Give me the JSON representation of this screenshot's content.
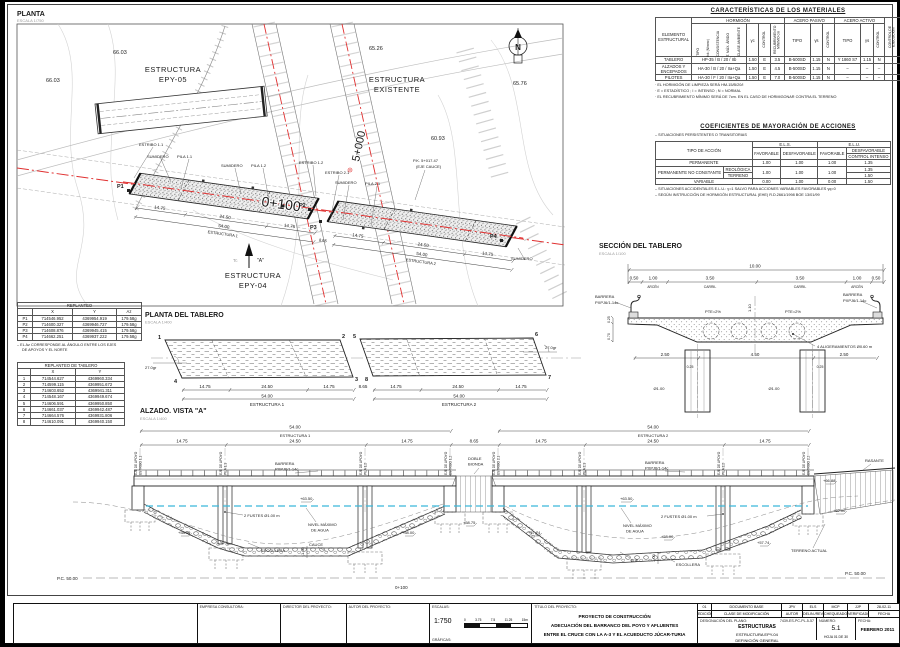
{
  "plan": {
    "title": "PLANTA",
    "scale": "ESCALA 1/750",
    "structures": {
      "epy05a": "ESTRUCTURA",
      "epy05b": "EPY-05",
      "exa": "ESTRUCTURA",
      "exb": "EXISTENTE",
      "epy04a": "ESTRUCTURA",
      "epy04b": "EPY-04"
    },
    "contours": {
      "c1": "66.03",
      "c2": "66.03",
      "c3": "65.26",
      "c4": "60.93",
      "c5": "65.76"
    },
    "stations": {
      "s1": "5+000",
      "s2": "0+100"
    },
    "points": {
      "p1": "P1",
      "p2": "P2",
      "p3": "P3",
      "p4": "P4"
    },
    "callouts": {
      "estribo11": "ESTRIBO 1.1",
      "sumidero": "SUMIDERO",
      "pila11": "PILA 1.1",
      "pila12": "PILA 1.2",
      "estribo12": "ESTRIBO 1.2",
      "estribo21": "ESTRIBO 2.1",
      "pila21": "PILA 2.1",
      "pk": "P.K. 5+017.47",
      "pk2": "(EJE CAUCE)"
    },
    "dims": {
      "d1475": "14.75",
      "d2450": "24.50",
      "d5400": "54.00",
      "e1": "ESTRUCTURA 1",
      "e2": "ESTRUCTURA 2",
      "d865": "8.65"
    },
    "view_arrow": "\"A\"",
    "view_tc": "Tc",
    "north": "N"
  },
  "materials": {
    "title": "CARACTERÍSTICAS DE LOS MATERIALES",
    "h_elem": "ELEMENTO ESTRUCTURAL",
    "h_horm": "HORMIGÓN",
    "h_pasivo": "ACERO PASIVO",
    "h_activo": "ACERO ACTIVO",
    "h_tipo": "TIPO",
    "h_fck": "fck (N/mm²)",
    "h_cons": "CONSISTENCIA",
    "h_arido": "T. MÁX. ÁRIDO",
    "h_amb": "CLASE AMBIENTE",
    "h_gc": "γc",
    "h_control": "CONTROL",
    "h_recub": "RECUBRIMIENTO MÍNIMO cm",
    "h_gs": "γs",
    "h_ejec": "CONTROL DE EJECUCIÓN",
    "rows": [
      [
        "TABLERO",
        "HP-35 / B / 20 / IIb",
        "1.50",
        "E",
        "3.5",
        "B-500SD",
        "1.15",
        "N",
        "Y 1860 S7",
        "1.15",
        "N",
        "I"
      ],
      [
        "ALZADOS Y ENCEPADOS",
        "HA-30 / B / 20 / IIa+Qa",
        "1.50",
        "E",
        "4.5",
        "B-500SD",
        "1.15",
        "N",
        "–",
        "–",
        "–",
        "I"
      ],
      [
        "PILOTES",
        "HA-30 / F / 20 / IIa+Qa",
        "1.50",
        "E",
        "7.0",
        "B-500SD",
        "1.15",
        "N",
        "–",
        "–",
        "–",
        "I"
      ]
    ],
    "notes": [
      "· EL HORMIGÓN DE LIMPIEZA SERÁ HM-15/B/20/I",
      "· E = ESTADÍSTICO ; I = INTENSO ; N = NORMAL",
      "· EL RECUBRIMIENTO MÍNIMO SERÁ DE 7cm. EN EL CASO DE HORMIGONAR CONTRA EL TERRENO"
    ]
  },
  "coefs": {
    "title": "COEFICIENTES DE MAYORACIÓN DE ACCIONES",
    "subtitle": "– SITUACIONES PERSISTENTES O TRANSITORIAS",
    "h_tipo": "TIPO DE ACCIÓN",
    "h_els": "E.L.S.",
    "h_elu": "E.L.U.",
    "h_fav": "FAVORABLE",
    "h_desf": "DESFAVORABLE",
    "h_ci": "CONTROL INTENSO",
    "r1": "PERMANENTE",
    "r1v": [
      "1.00",
      "1.00",
      "1.00",
      "1.35"
    ],
    "r2": "PERMANENTE NO CONSTANTE",
    "r2a": "REOLÓGICA",
    "r2b": "TERRENO",
    "r2v": [
      "1.00",
      "1.00",
      "1.00"
    ],
    "r2va": "1.35",
    "r2vb": "1.50",
    "r3": "VARIABLE",
    "r3v": [
      "0.00",
      "1.00",
      "0.00",
      "1.50"
    ],
    "notes": [
      "– SITUACIONES ACCIDENTALES E.L.U.: γ=1 SALVO PARA ACCIONES VARIABLES FAVORABLES γq=0",
      "– SEGÚN INSTRUCCIÓN DE HORMIGÓN ESTRUCTURAL (EHE) R.D.2661/1998 BOE 13/01/99"
    ]
  },
  "replanteo": {
    "title": "REPLANTEO",
    "headers": [
      "",
      "X",
      "Y",
      "Az"
    ],
    "rows": [
      [
        "P1",
        "714546.952",
        "4369954.919",
        "179.58g"
      ],
      [
        "P2",
        "714600.327",
        "4369946.727",
        "179.58g"
      ],
      [
        "P3",
        "714608.876",
        "4369945.415",
        "179.58g"
      ],
      [
        "P4",
        "714662.251",
        "4369937.222",
        "179.58g"
      ]
    ],
    "note1": "– EL Az CORRESPONDE AL ÁNGULO ENTRE LOS EJES",
    "note2": "DE APOYOS Y EL NORTE"
  },
  "replanteo_tablero": {
    "title": "REPLANTEO DE TABLERO",
    "headers": [
      "",
      "X",
      "Y"
    ],
    "rows": [
      [
        "1",
        "714544.627",
        "4369960.334"
      ],
      [
        "2",
        "714599.115",
        "4369951.672"
      ],
      [
        "3",
        "714603.652",
        "4369941.311"
      ],
      [
        "4",
        "714548.167",
        "4369949.674"
      ],
      [
        "5",
        "714606.591",
        "4369950.850"
      ],
      [
        "6",
        "714661.037",
        "4369942.487"
      ],
      [
        "7",
        "714664.576",
        "4369931.806"
      ],
      [
        "8",
        "714610.091",
        "4369940.150"
      ]
    ]
  },
  "section": {
    "title": "SECCIÓN DEL TABLERO",
    "scale": "ESCALA 1/100",
    "dims": {
      "total": "10.00",
      "d050": "0.50",
      "d100": "1.00",
      "d350": "3.50",
      "arcen": "ARCÉN",
      "carril": "CARRIL",
      "d250": "2.50",
      "d450": "4.50",
      "d025": "0.25",
      "d070": "0.70",
      "d110": "1.10",
      "dia": "Ø1.00"
    },
    "labels": {
      "pte": "PTE=2%",
      "bar1": "BARRERA",
      "bar2": "PXPJ6/1-14c",
      "alig": "4 ALIGERAMIENTOS Ø0.60 m"
    }
  },
  "deck_plan": {
    "title": "PLANTA DEL TABLERO",
    "scale": "ESCALA 1/400",
    "corners": [
      "1",
      "2",
      "3",
      "4",
      "5",
      "6",
      "7",
      "8"
    ],
    "angle": "27.0gr",
    "dims": {
      "d1475": "14.75",
      "d2450": "24.50",
      "d5400": "54.00",
      "e1": "ESTRUCTURA 1",
      "e2": "ESTRUCTURA 2",
      "gap": "8.65"
    }
  },
  "elevation": {
    "title": "ALZADO. VISTA \"A\"",
    "scale": "ESCALA 1/400",
    "dims": {
      "d5400": "54.00",
      "e1": "ESTRUCTURA 1",
      "e2": "ESTRUCTURA 2",
      "d1475": "14.75",
      "d2450": "24.50",
      "gap": "8.65",
      "d100": "1.00"
    },
    "axes": {
      "eje": "EJE DE APOYO",
      "e11": "ESTRIBO 1.1",
      "p11": "PILA 1.1",
      "p12": "PILA 1.2",
      "e12": "ESTRIBO 1.2",
      "e21": "ESTRIBO 2.1",
      "p21": "PILA 2.1",
      "p22": "PILA 2.2",
      "e22": "ESTRIBO 2.2"
    },
    "labels": {
      "bar1": "BARRERA",
      "bar2": "PXPJ6/1-14c",
      "doble1": "DOBLE",
      "doble2": "BIONDA",
      "rasante": "RASANTE",
      "nivel1": "NIVEL MÁXIMO",
      "nivel2": "DE AGUA",
      "fustes": "2 FUSTES Ø1.00 m",
      "escollera": "ESCOLLERA",
      "cauce": "CAUCE",
      "eje": "EJE",
      "terreno": "TERRENO ACTUAL",
      "l6350": "+63.50",
      "l6688": "+66.88",
      "l6200": "+62.00",
      "l5800": "+58.00",
      "l5875": "+58.75",
      "l5774": "+57.74",
      "pc": "P.C. 50.00",
      "st": "0+100"
    }
  },
  "titleblock": {
    "empresa": "EMPRESA CONSULTORA:",
    "director": "DIRECTOR DEL PROYECTO:",
    "autor": "AUTOR DEL PROYECTO:",
    "escalas": "ESCALAS:",
    "escala_num": "1:750",
    "graficas": "GRÁFICAS:",
    "bar": [
      "0",
      "3.75",
      "7.5",
      "11.25",
      "15m"
    ],
    "titulo_label": "TÍTULO DEL PROYECTO:",
    "titulo": [
      "PROYECTO DE CONSTRUCCIÓN",
      "ADECUACIÓN DEL BARRANCO DEL POYO Y AFLUENTES",
      "ENTRE EL CRUCE CON LA A-3 Y EL ACUEDUCTO JÚCAR-TURIA"
    ],
    "rev": [
      "01",
      "DOCUMENTO BASE",
      "JPV",
      "ELS",
      "MCP",
      "JJP",
      "28-02-11"
    ],
    "rev_labels": [
      "EDICIÓN",
      "CLASE DE MODIFICACIÓN",
      "AUTOR",
      "DELIN./REV.",
      "CHEQUEADO",
      "VERIFICADO",
      "FECHA"
    ],
    "designacion_label": "DESIGNACIÓN DEL PLANO:",
    "codigo": "7439-ES-PC-PL-5-57",
    "plano": [
      "ESTRUCTURAS",
      "ESTRUCTURA EPY-04",
      "DEFINICIÓN GENERAL"
    ],
    "numero_label": "NÚMERO:",
    "numero": "5.1",
    "hoja": "HOJA 01 DE 30",
    "fecha_label": "FECHA:",
    "fecha": "FEBRERO 2011"
  }
}
